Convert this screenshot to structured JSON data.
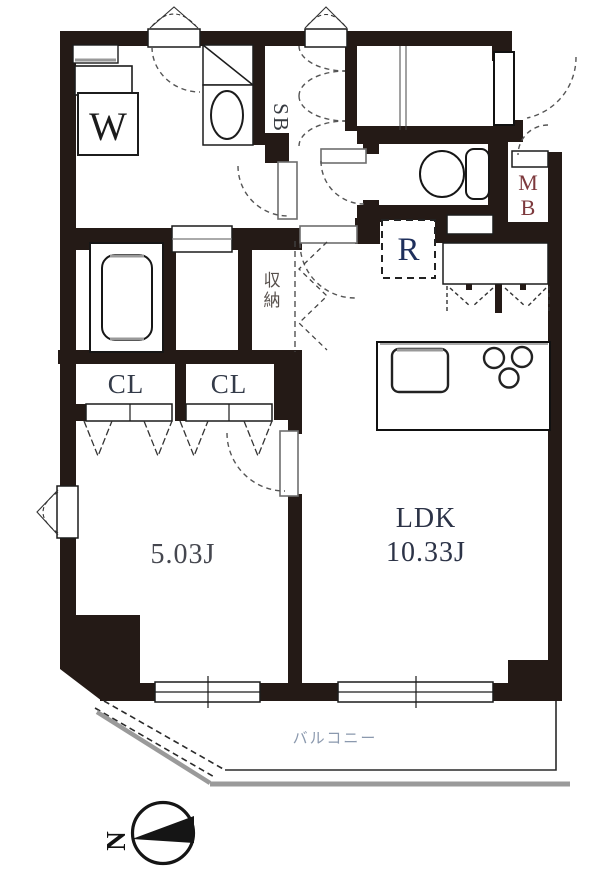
{
  "floorplan": {
    "rooms": {
      "ldk": {
        "name": "LDK",
        "area": "10.33J"
      },
      "bedroom": {
        "area": "5.03J"
      },
      "balcony": {
        "name": "バルコニー"
      },
      "storage": {
        "name": "収納"
      },
      "closet_left": {
        "name": "CL"
      },
      "closet_right": {
        "name": "CL"
      }
    },
    "fixtures": {
      "washer_label": "W",
      "shoe_box_label": "SB",
      "refrigerator_label": "R",
      "meter_box_line1": "M",
      "meter_box_line2": "B"
    },
    "compass": {
      "north_label": "N"
    },
    "colors": {
      "wall": "#241a16",
      "bedroom_label": "#45474f",
      "ldk_label": "#2c3347",
      "refrigerator_label": "#1e2f5c",
      "meter_box_label": "#7d393d",
      "balcony_label": "#8b99ae"
    }
  }
}
